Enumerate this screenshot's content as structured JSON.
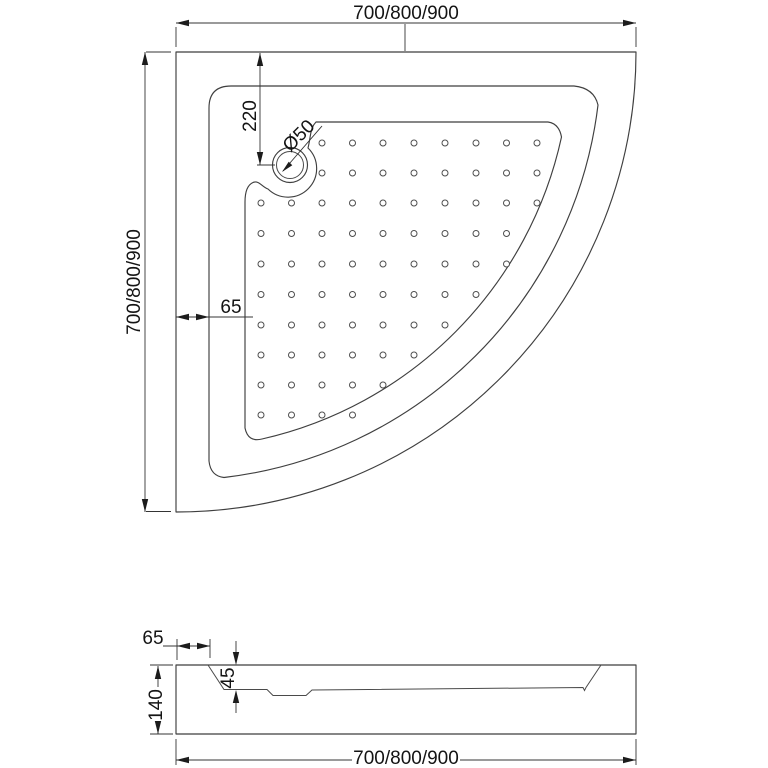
{
  "drawing": {
    "type": "technical-drawing",
    "subject": "quadrant-shower-tray",
    "colors": {
      "background": "#ffffff",
      "geometry_line": "#3f3f3f",
      "dimension_line": "#343434",
      "text": "#141414"
    },
    "top_view": {
      "dim_width": "700/800/900",
      "dim_height": "700/800/900",
      "dim_drain_offset": "220",
      "dim_drain_diameter": "Ø50",
      "dim_rim_width": "65"
    },
    "side_view": {
      "dim_width": "700/800/900",
      "dim_edge_offset": "65",
      "dim_basin_depth": "45",
      "dim_total_height": "140"
    },
    "dots": {
      "radius": 3,
      "cols_x": [
        261,
        291.5,
        322,
        352.5,
        383,
        414,
        445,
        476,
        506.5,
        537
      ],
      "rows_y": [
        143,
        173,
        203,
        233.5,
        264,
        294.5,
        325,
        355,
        385,
        415
      ],
      "row_col_ranges": [
        [
          2,
          9
        ],
        [
          2,
          9
        ],
        [
          0,
          9
        ],
        [
          0,
          8
        ],
        [
          0,
          8
        ],
        [
          0,
          7
        ],
        [
          0,
          6
        ],
        [
          0,
          5
        ],
        [
          0,
          4
        ],
        [
          0,
          3
        ]
      ]
    }
  }
}
